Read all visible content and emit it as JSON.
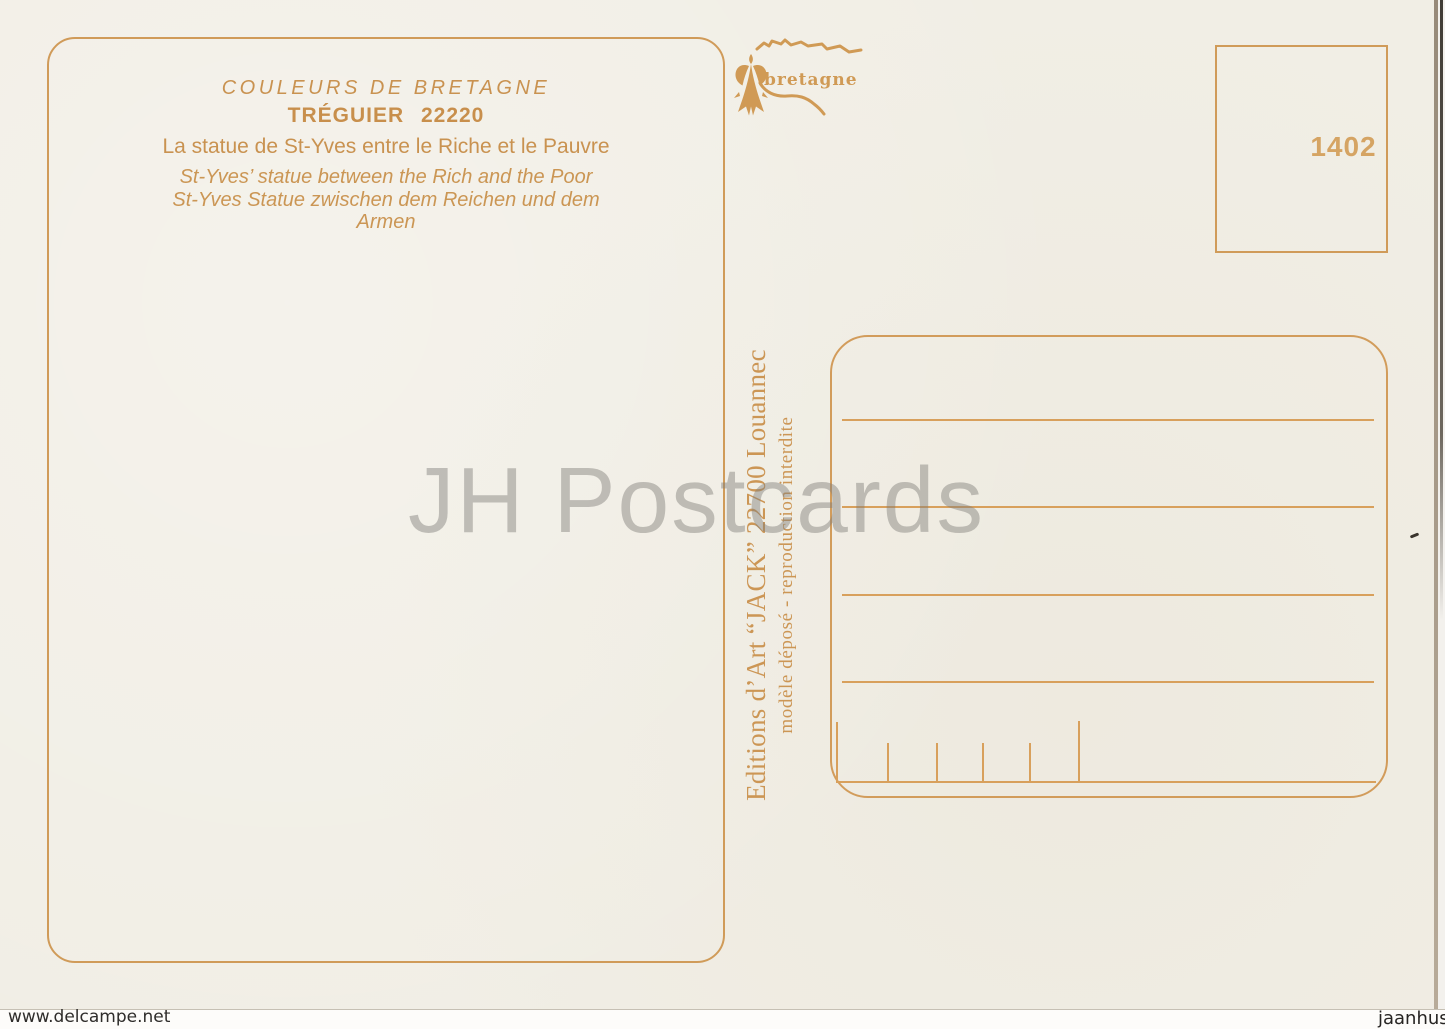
{
  "postcard": {
    "header": {
      "series": "COULEURS DE BRETAGNE",
      "town": "TRÉGUIER 22220",
      "caption_fr": "La statue de St-Yves entre le Riche et le Pauvre",
      "caption_en": "St-Yves’ statue between the Rich and the Poor",
      "caption_de_line1": "St-Yves Statue zwischen dem Reichen und dem",
      "caption_de_line2": "Armen"
    },
    "logo": {
      "text": "bretagne"
    },
    "stamp_box": {
      "number": "1402"
    },
    "publisher": {
      "line1": "Editions d’Art “JACK” 22700 Louannec",
      "line2": "modèle déposé - reproduction interdite"
    }
  },
  "watermarks": {
    "center": "JH Postcards",
    "bottom_left": "www.delcampe.net",
    "bottom_right": "jaanhus"
  },
  "colors": {
    "ink_orange": "#d09b59",
    "text_orange": "#c99250",
    "card_background": "#f1eee5",
    "watermark_gray": "#c7c5c1"
  }
}
